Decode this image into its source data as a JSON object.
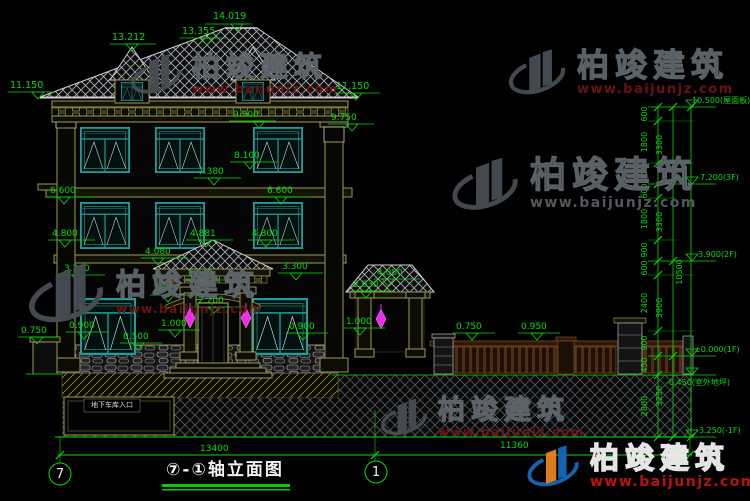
{
  "title": {
    "text": "⑦-①轴立面图"
  },
  "axis": {
    "left": "7",
    "right": "1"
  },
  "notes": {
    "garage": "地下车库入口"
  },
  "watermark": {
    "name": "柏竣建筑",
    "url": "www.baijunjz.com"
  },
  "labels": {
    "e14019": "14.019",
    "e13355": "13.355",
    "e13212": "13.212",
    "e11150l": "11.150",
    "e11150r": "11.150",
    "e9900": "9.900",
    "e9750": "9.750",
    "e8100": "8.100",
    "e7380": "7.380",
    "e6600l": "6.600",
    "e6600r": "6.600",
    "e4800l": "4.800",
    "e4881": "4.881",
    "e4800r": "4.800",
    "e4080l": "4.080",
    "e4080r": "4.080",
    "e3300l": "3.300",
    "e3300r": "3.300",
    "e3040": "3.040",
    "e2650": "2.650",
    "e2630": "2.630",
    "e2200": "2.200",
    "e1000l": "1.000",
    "e1000r": "1.000",
    "e0900l": "0.900",
    "e0900r": "0.900",
    "e0500": "0.500",
    "e0750l": "0.750",
    "e0750f": "0.750",
    "e0950": "0.950"
  },
  "marks": {
    "roof": "10.500(屋面板)",
    "f3": "7.200(3F)",
    "f2": "3.900(2F)",
    "f1": "±0.000(1F)",
    "outdoor": "-0.450(室外地坪)",
    "b1": "-3.250(-1F)"
  },
  "dims": {
    "w_left": "13400",
    "w_right": "11360",
    "chain": [
      "600",
      "1800",
      "900",
      "600",
      "1800",
      "900",
      "600",
      "2400",
      "900",
      "450",
      "2800"
    ],
    "totals": [
      "3300",
      "3300",
      "3900",
      "3250"
    ],
    "total_height": "10500"
  },
  "colors": {
    "dim": "#00dc00",
    "window": "#1d9e9e",
    "trim": "#9a9a50",
    "lamp": "#f02bf0",
    "brand_red": "#c51111"
  }
}
